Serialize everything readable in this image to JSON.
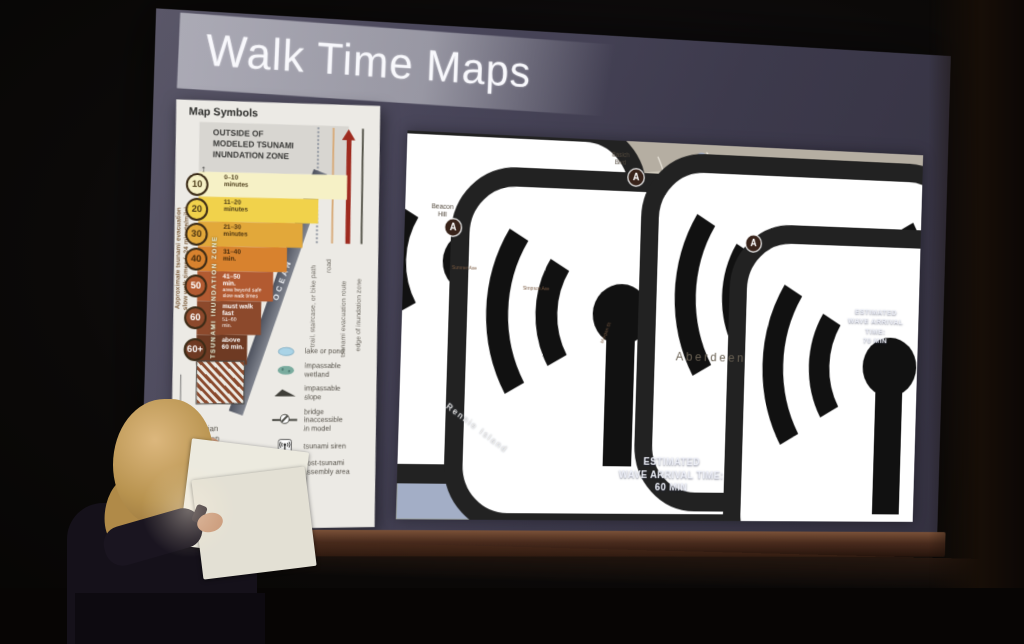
{
  "slide": {
    "title": "Walk Time Maps"
  },
  "legend": {
    "title": "Map Symbols",
    "outside_zone": "OUTSIDE OF\nMODELED TSUNAMI\nINUNDATION ZONE",
    "axis_label": "Approximate tsunami evacuation\nslow walk times (~24 minute/mile)",
    "zone_strip_label": "TSUNAMI INUNDATION ZONE",
    "ocean_label": "OCEAN",
    "bands": [
      {
        "badge": "10",
        "label": "0–10\nminutes",
        "note": "",
        "color": "#f6f1c6",
        "ink": "#4a3a18"
      },
      {
        "badge": "20",
        "label": "11–20\nminutes",
        "note": "",
        "color": "#f1d24b",
        "ink": "#4a3a18"
      },
      {
        "badge": "30",
        "label": "21–30\nminutes",
        "note": "",
        "color": "#e2a83a",
        "ink": "#4a3211"
      },
      {
        "badge": "40",
        "label": "31–40\nmin.",
        "note": "",
        "color": "#d8822e",
        "ink": "#3f280c"
      },
      {
        "badge": "50",
        "label": "41–50\nmin.",
        "note": "area beyond safe\nslow-walk times",
        "color": "#b25a31",
        "ink": "#ffffff"
      },
      {
        "badge": "60",
        "label": "must walk\nfast",
        "note": "51–60\nmin.",
        "color": "#8c492c",
        "ink": "#ffffff"
      },
      {
        "badge": "60+",
        "label": "above\n60 min.",
        "note": "",
        "color": "#6e3a23",
        "ink": "#ffffff"
      }
    ],
    "line_symbols": [
      {
        "label": "trail, staircase, or bike path"
      },
      {
        "label": "road"
      },
      {
        "label": "tsunami evacuation route"
      },
      {
        "label": "edge of inundation zone"
      }
    ],
    "pedestrian_note": "pedestrian\nevacuation\nnot possible\nin model",
    "point_symbols": [
      {
        "label": "lake or pond"
      },
      {
        "label": "impassable\nwetland"
      },
      {
        "label": "impassable\nslope"
      },
      {
        "label": "bridge\ninaccessible\nin model"
      },
      {
        "label": "tsunami siren"
      },
      {
        "label": "post-tsunami\nassembly area"
      }
    ]
  },
  "map": {
    "city": "Aberdeen",
    "labels": {
      "beacon_hill": "Beacon\nHill",
      "basich_blvd": "Basich\nBlvd",
      "rennie_island": "Rennie Island"
    },
    "streets": {
      "sumner": "Sumner Ave",
      "simpson": "Simpson Ave",
      "morgan": "Morgan St"
    },
    "shields": {
      "us101": "US101",
      "sr105": "SR105"
    },
    "zones": {
      "z10": "10",
      "z20": "20",
      "z30": "30",
      "z40": "40"
    },
    "assembly_letter": "A",
    "wave_60": "ESTIMATED\nWAVE ARRIVAL TIME:\n60 MIN",
    "wave_70": "ESTIMATED\nWAVE ARRIVAL TIME:\n70 MIN"
  },
  "colors": {
    "slide_bg": "#413e4f",
    "title_band": "#9b9aa6",
    "water": "#a3aec6",
    "hills": "#b5aea2",
    "zone_yellow": "#f4e6a0",
    "zone_gold": "#eecc62",
    "zone_orange": "#e2992f",
    "route_red": "#8f2517",
    "road_red": "#b73c28",
    "screen_bezel": "#46291c"
  }
}
